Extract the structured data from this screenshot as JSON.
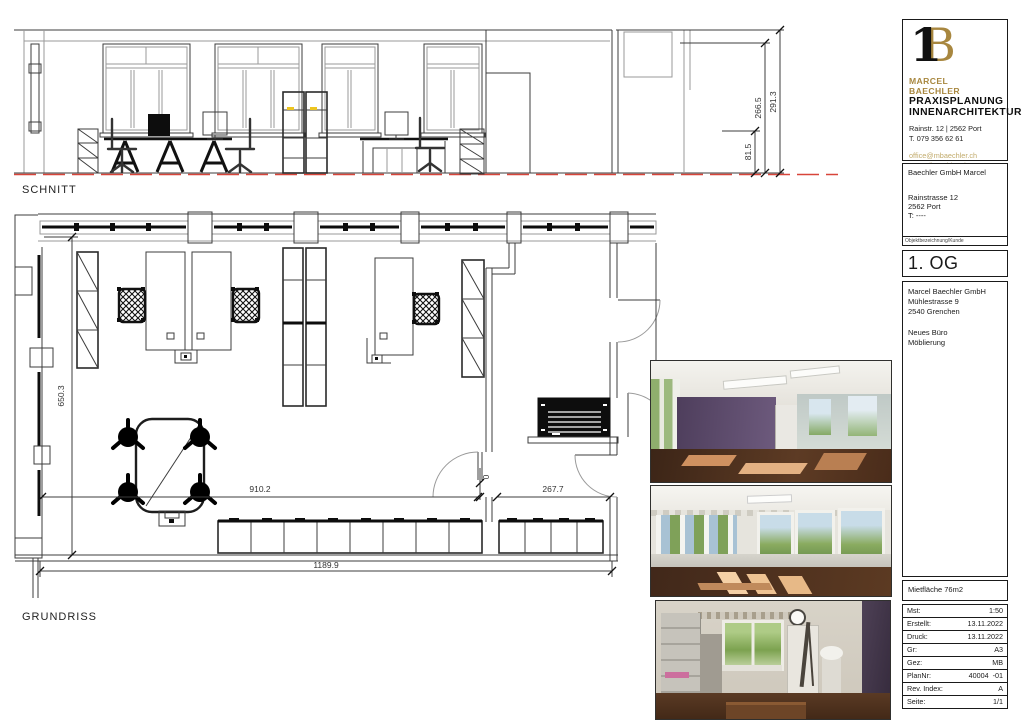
{
  "sheet": {
    "section_label": "SCHNITT",
    "plan_label": "GRUNDRISS"
  },
  "dims": {
    "sec_right_outer": "291.3",
    "sec_right_inner": "266.5",
    "sec_right_lower": "81.5",
    "plan_left": "650.3",
    "plan_width_main": "910.2",
    "plan_width_right": "267.7",
    "plan_width_total": "1189.9",
    "plan_door": "0"
  },
  "titleblock": {
    "logo": {
      "monogram_1": "1",
      "monogram_b": "B",
      "name": "MARCEL BAECHLER",
      "line1": "PRAXISPLANUNG",
      "line2": "INNENARCHITEKTUR",
      "address": "Rainstr. 12 | 2562 Port",
      "phone": "T. 079 356 62 61",
      "email": "office@mbaechler.ch",
      "web": "marcelbaechler.ch"
    },
    "client": {
      "name": "Baechler GmbH Marcel",
      "street": "Rainstrasse 12",
      "city": "2562 Port",
      "tel": "T: ----",
      "caption": "Objektbezeichnung/Kunde"
    },
    "floor_label": "1. OG",
    "project": {
      "company": "Marcel Baechler GmbH",
      "street": "Mühlestrasse 9",
      "city": "2540 Grenchen",
      "desc1": "Neues Büro",
      "desc2": "Möblierung"
    },
    "area_label": "Mietfläche 76m2",
    "table": {
      "rows": [
        {
          "label": "Mst:",
          "value": "1:50"
        },
        {
          "label": "Erstellt:",
          "value": "13.11.2022"
        },
        {
          "label": "Druck:",
          "value": "13.11.2022"
        },
        {
          "label": "Gr:",
          "value": "A3"
        },
        {
          "label": "Gez:",
          "value": "MB"
        },
        {
          "label": "PlanNr:",
          "value": "40004  -01"
        },
        {
          "label": "Rev. Index:",
          "value": "A"
        },
        {
          "label": "Seite:",
          "value": "1/1"
        }
      ]
    }
  },
  "colors": {
    "brand_gold": "#a8873f",
    "link_gold": "#c2ab6c",
    "section_red": "#d8453a"
  }
}
